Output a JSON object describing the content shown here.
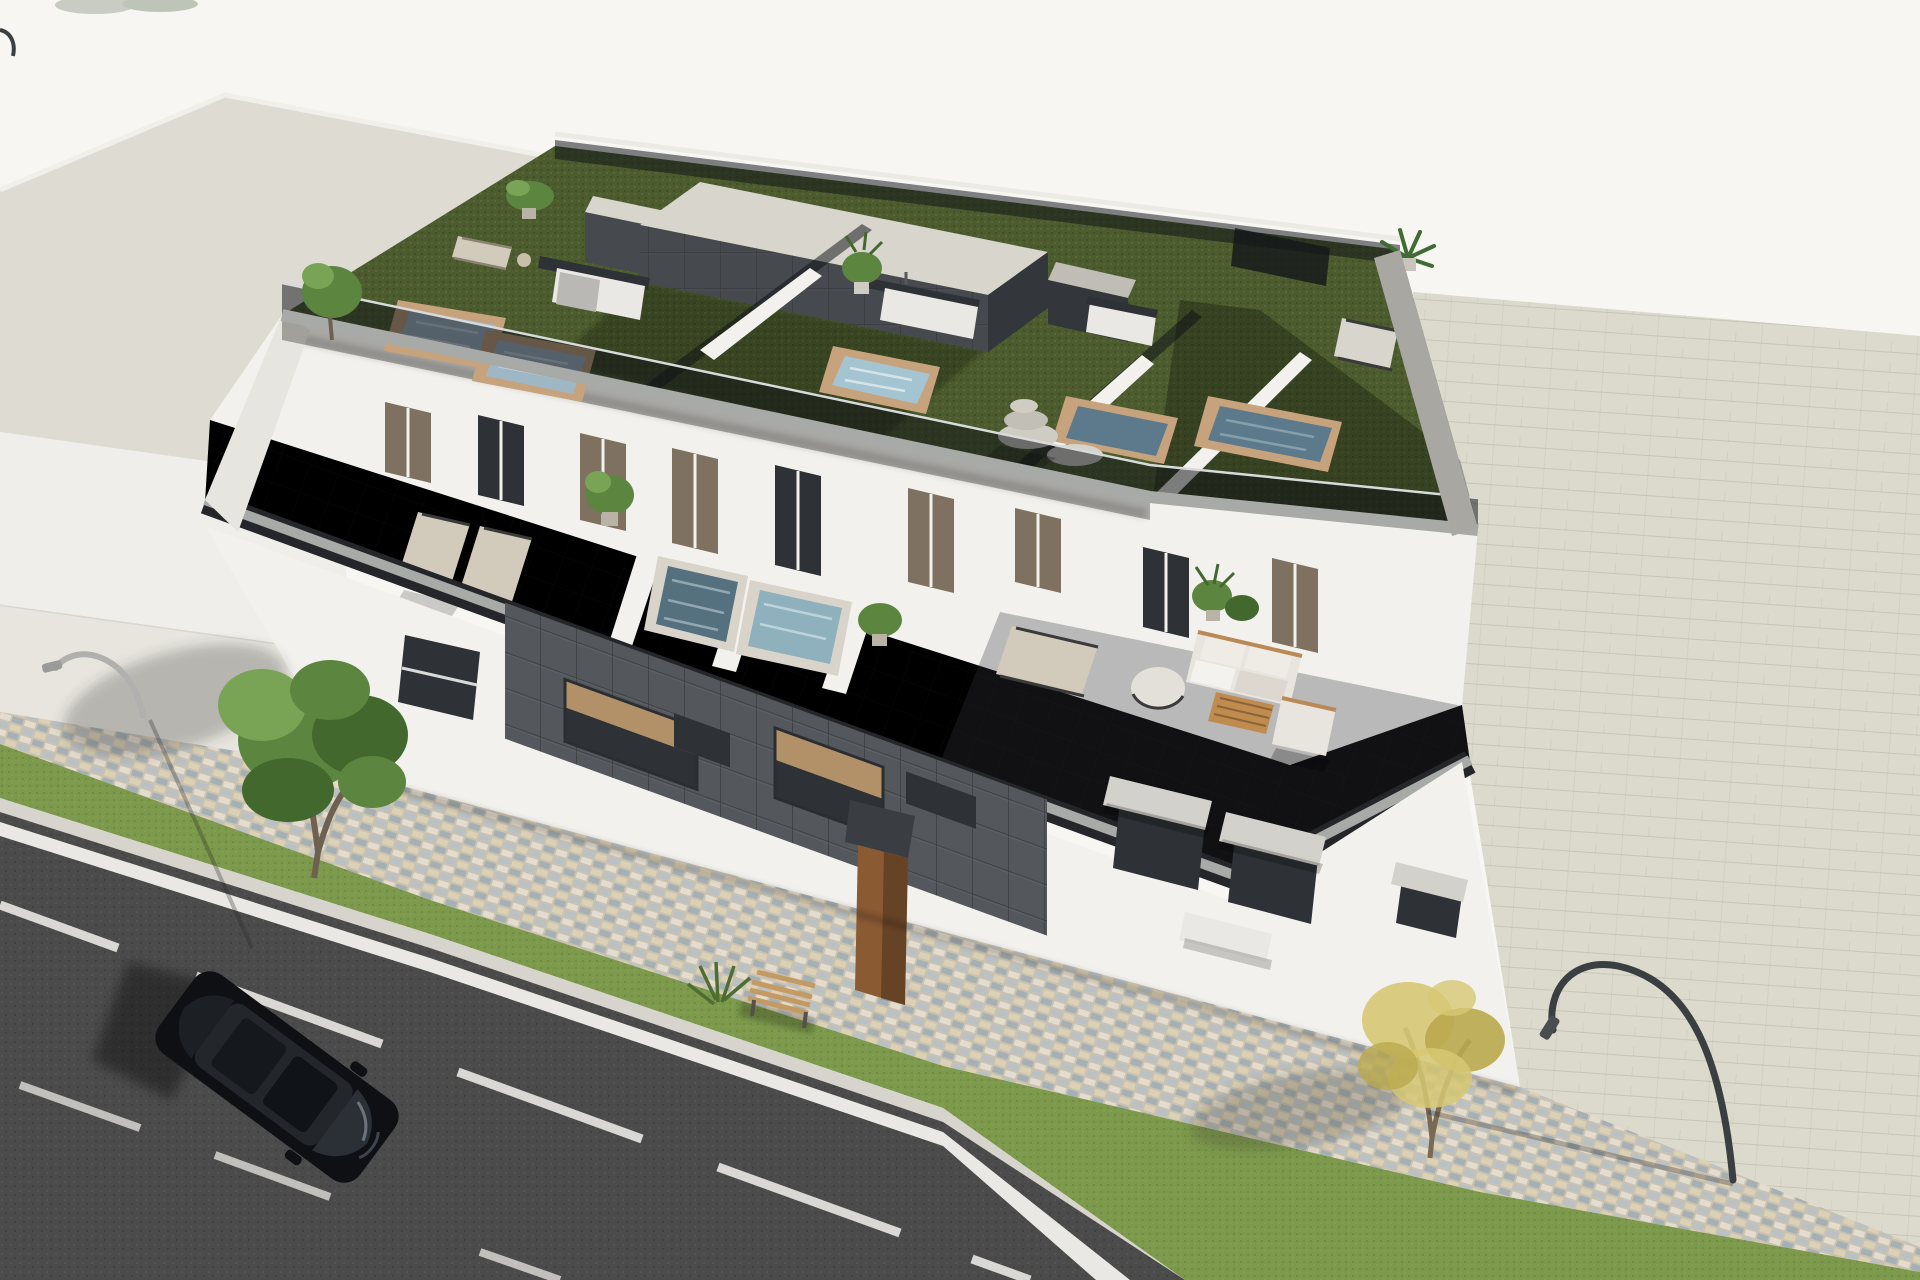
{
  "scene": {
    "type": "3d-architectural-render",
    "description": "Aerial 3/4 view CGI render of a modern three-storey apartment building with rooftop terraces, artificial turf, private plunge pools and smoked-glass railings; in front runs a cobblestone sidewalk, a grass verge with trees, a bench, curved street lamps and an asphalt road with a parked black car",
    "camera": "high aerial oblique",
    "style": "photorealistic architectural visualization",
    "text_visible": "none"
  },
  "colors": {
    "bg": "#f7f6f3",
    "neighborRoof": "#dedbd2",
    "neighborWall": "#efeeea",
    "pavementLeft": "#e7e5de",
    "pavementRight": "#dbdacd",
    "cobbleBase": "#c9c2b0",
    "grass": "#7d9a4c",
    "road": "#4b4b4b",
    "curb": "#d6d4cd",
    "roadLine": "#e9e8e4",
    "turf": "#4c5c2e",
    "facadeWhite": "#f2f1ed",
    "cladDark": "#54575c",
    "coreTop": "#d8d5cc",
    "coreDark": "#46494e",
    "coreMid": "#33363b",
    "glassSmoke": "rgba(15,18,23,0.52)",
    "poolWater": "#9fb7c4",
    "poolWaterDark": "#5d7a8c",
    "poolRim": "#c6a37c",
    "kitchenWhite": "#e9e8e4",
    "counterDark": "#2e3135",
    "cushion": "#d2cabb",
    "sofaWhite": "#e8e5df",
    "woodTable": "#c08b4e",
    "stone": "#cfccc4",
    "carBody": "#0e1013",
    "carGlass": "#23272c",
    "treeGreen": "#5c8540",
    "treeGreenDark": "#42682e",
    "treeGreenLight": "#79a355",
    "treeYellow": "#d6c873",
    "treeYellowDark": "#b9a94e",
    "trunk": "#6e6152",
    "benchWood": "#c49a62",
    "doorBrown": "#8a5a33",
    "windowLit": "#b29068",
    "windowGlass": "#2e3135",
    "doorBronze": "#7f7160",
    "awning": "#d3d1cb",
    "coping": "#a8aaa8",
    "parapetDark": "#24262a",
    "lampDark": "#3c3f42",
    "lampLight": "#b0b0ae"
  },
  "elements": {
    "neighbor_building": {
      "label": "flat-roof neighbouring building",
      "position": "upper left"
    },
    "main_building": {
      "label": "three-storey modern apartment block",
      "storeys": 3,
      "orientation": "diagonal, lower-left to upper-right"
    },
    "rooftop": {
      "label": "rooftop terraces with green turf",
      "plunge_pools": 5,
      "outdoor_kitchens": 3,
      "sun_loungers": 2,
      "glass_partitions": 3,
      "stair_core": "dark tiled stair core with light flat top",
      "plants": [
        "potted plant",
        "potted plant",
        "palm plant"
      ],
      "stone_decoration": "stacked stone sculpture and round stone table"
    },
    "terrace_level": {
      "label": "second floor terrace",
      "plunge_pools": 2,
      "sun_loungers": 3,
      "sofa_set": "white corner sofa",
      "coffee_table": "wooden slat table",
      "armchair": 1,
      "round_chair": 1,
      "potted_plants": 4,
      "doors": 9
    },
    "street_level": {
      "label": "street facade",
      "dark_cladding": "charcoal tile feature wall",
      "lit_recessed_windows": 2,
      "entrance_door": "brown entrance door",
      "awning_windows": 3,
      "planter_bench": "white planter bench"
    },
    "street": {
      "label": "asphalt road",
      "markings": "white solid edge line and dashed lane lines",
      "parked_car": "black SUV seen from above",
      "curb": "light stone curb"
    },
    "sidewalk": {
      "label": "sidewalk zone",
      "walkway": "multicolour cobblestone walkway",
      "verge": "grass strip",
      "bench": "wooden park bench",
      "trees": [
        "green leafy tree",
        "yellow autumn tree"
      ],
      "street_lamps": 2
    },
    "background": {
      "label": "large light paved ground plane",
      "right_pavement": "light grey brick pavement"
    }
  }
}
